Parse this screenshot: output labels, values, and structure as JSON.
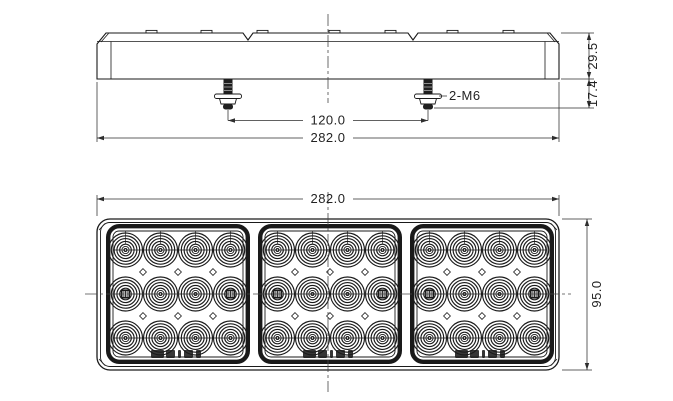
{
  "drawing": {
    "type": "engineering-drawing-led-combination-lamp",
    "colors": {
      "background": "#ffffff",
      "line": "#1a1a1a",
      "dimension": "#2e2e2e"
    },
    "views": {
      "side_view": {
        "label": "side-profile-view",
        "dimensions": {
          "bolt_spacing": "120.0",
          "overall_width": "282.0",
          "body_height": "29.5",
          "stud_length": "17.4"
        },
        "callouts": {
          "mounting_studs": "2-M6"
        },
        "stud_count": 2
      },
      "front_view": {
        "label": "front-face-view",
        "dimensions": {
          "overall_width": "282.0",
          "overall_height": "95.0"
        },
        "panel_count": 3,
        "led_columns_per_panel": 4,
        "led_rows_per_panel": 3,
        "panel_marking": "illegible-logo-stamp"
      }
    }
  }
}
